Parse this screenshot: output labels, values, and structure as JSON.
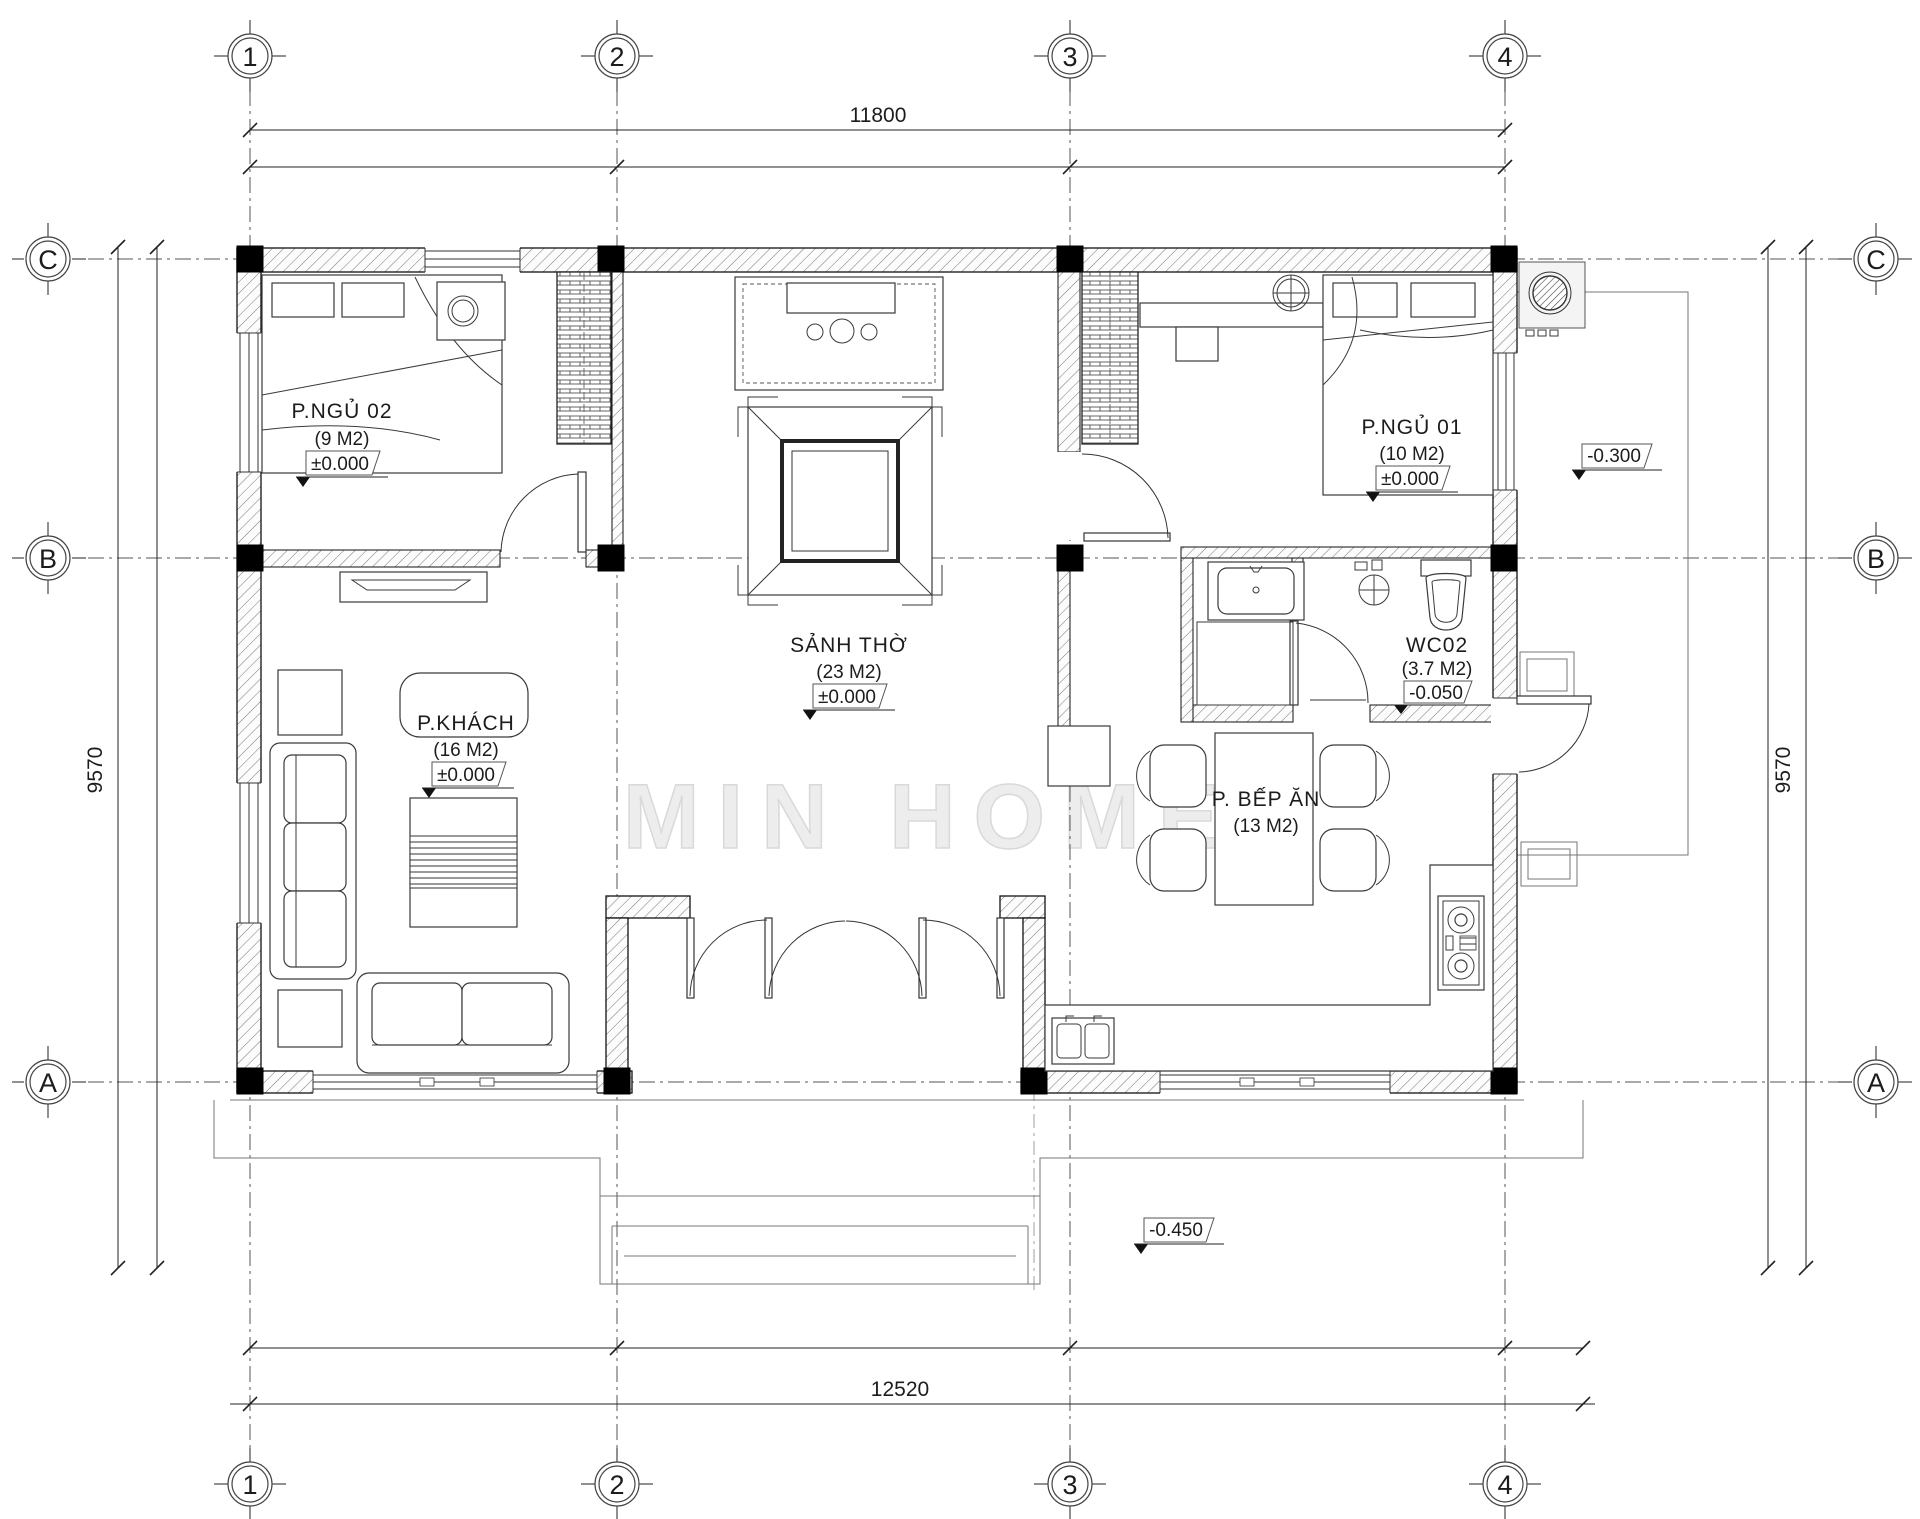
{
  "watermark": "MIN HOME",
  "grid": {
    "columns": [
      "1",
      "2",
      "3",
      "4"
    ],
    "rows": [
      "C",
      "B",
      "A"
    ]
  },
  "dimensions": {
    "top": "11800",
    "bottom": "12520",
    "left": "9570",
    "right": "9570"
  },
  "rooms": [
    {
      "name": "P.NGỦ 02",
      "area": "(9 M2)",
      "level": "±0.000"
    },
    {
      "name": "P.NGỦ 01",
      "area": "(10 M2)",
      "level": "±0.000"
    },
    {
      "name": "SẢNH THỜ",
      "area": "(23 M2)",
      "level": "±0.000"
    },
    {
      "name": "P.KHÁCH",
      "area": "(16 M2)",
      "level": "±0.000"
    },
    {
      "name": "WC02",
      "area": "(3.7 M2)",
      "level": "-0.050"
    },
    {
      "name": "P. BẾP ĂN",
      "area": "(13 M2)"
    }
  ],
  "site_levels": {
    "terrace_right": "-0.300",
    "porch_front": "-0.450"
  }
}
